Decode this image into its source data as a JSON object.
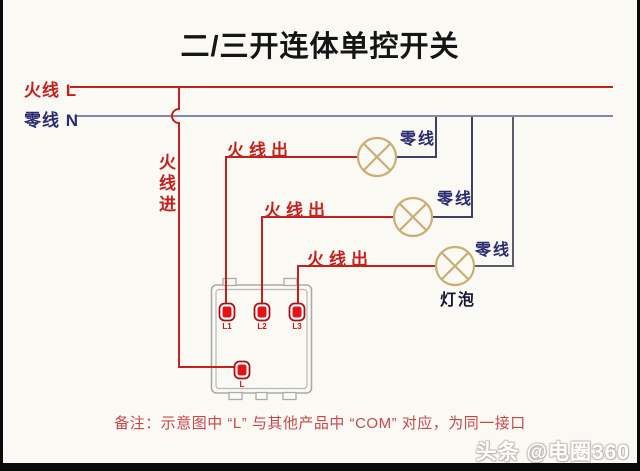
{
  "title": "二/三开连体单控开关",
  "legend": {
    "live": "火线 L",
    "neutral": "零线 N"
  },
  "labels": {
    "live_in": "火线进",
    "live_out": [
      "火线出",
      "火线出",
      "火线出"
    ],
    "neutral": [
      "零线",
      "零线",
      "零线"
    ],
    "bulb": "灯泡"
  },
  "switch": {
    "terminals": [
      "L1",
      "L2",
      "L3"
    ],
    "com": "L"
  },
  "note": "备注：示意图中 “L” 与其他产品中 “COM” 对应，为同一接口",
  "watermark": "头条 @电圈360",
  "colors": {
    "live_red": "#c4201d",
    "terminal_red": "#e41217",
    "terminal_ring": "#a51217",
    "neutral_text": "#2b2b72",
    "neutral_bus": "#8787a9",
    "neutral_wire": "#3f3f6b",
    "lamp_gold": "#c9af74",
    "box_gray": "#aaaaaa",
    "note_red": "#c8474c",
    "background": "#fbf9f4"
  }
}
